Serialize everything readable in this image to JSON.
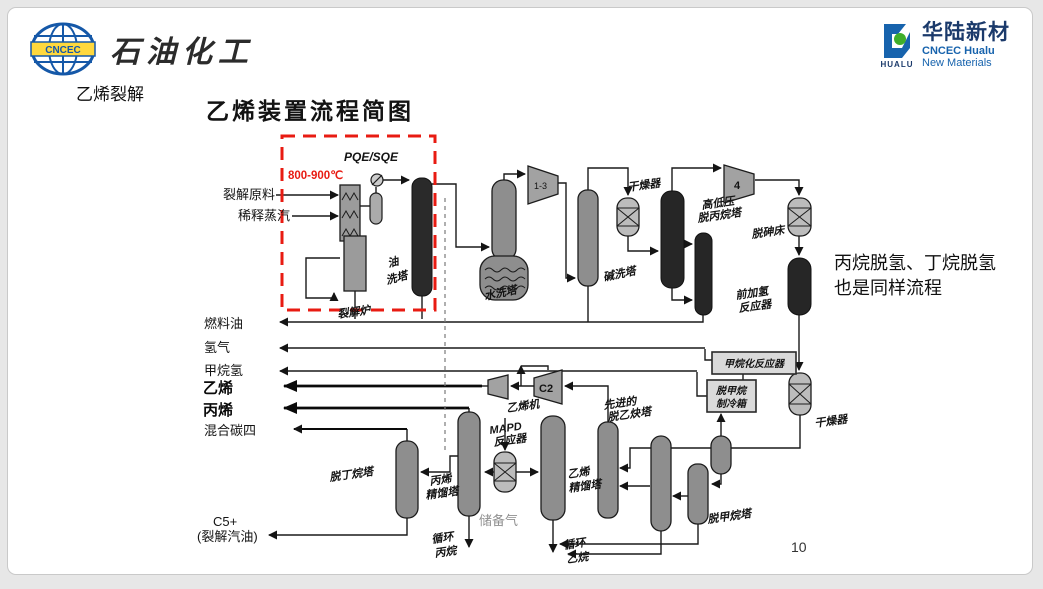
{
  "header": {
    "left_logo": {
      "banner": "CNCEC",
      "brand": "石油化工"
    },
    "right_logo": {
      "cn": "华陆新材",
      "en1": "CNCEC Hualu",
      "en2": "New Materials",
      "word": "HUALU"
    }
  },
  "slide": {
    "section": "乙烯裂解",
    "title": "乙烯装置流程简图",
    "note1": "丙烷脱氢、丁烷脱氢",
    "note2": "也是同样流程",
    "page": "10"
  },
  "diagram": {
    "feed1": "裂解原料",
    "feed2": "稀释蒸汽",
    "temp": "800-900℃",
    "pqe": "PQE/SQE",
    "furnace": "裂解炉",
    "oil1": "油",
    "oil2": "洗塔",
    "water": "水洗塔",
    "caustic": "碱洗塔",
    "dryer_top": "干燥器",
    "hplp1": "高低压",
    "hplp2": "脱丙烷塔",
    "dearsenic": "脱砷床",
    "fh1": "前加氢",
    "fh2": "反应器",
    "methanation": "甲烷化反应器",
    "cb1": "脱甲烷",
    "cb2": "制冷箱",
    "dryer_right": "干燥器",
    "demethanizer": "脱甲烷塔",
    "da1": "先进的",
    "da2": "脱乙炔塔",
    "ec1": "乙烯",
    "ec2": "精馏塔",
    "re1": "循环",
    "re2": "乙烷",
    "mapd1": "MAPD",
    "mapd2": "反应器",
    "reserve": "储备气",
    "pc1": "丙烯",
    "pc2": "精馏塔",
    "rp1": "循环",
    "rp2": "丙烷",
    "debutanizer": "脱丁烷塔",
    "k13": "1-3",
    "k4": "4",
    "kc2": "C2",
    "emachine": "乙烯机",
    "fuel": "燃料油",
    "h2": "氢气",
    "ch4h2": "甲烷氢",
    "ethylene": "乙烯",
    "propylene": "丙烯",
    "c4": "混合碳四",
    "c5": "C5+",
    "c5sub": "(裂解汽油)"
  },
  "colors": {
    "accent_red": "#e81b12",
    "logo_blue": "#1558a8",
    "logo_yellow": "#ffd83d",
    "logo_green": "#3fae2a",
    "navy": "#1b3a6b"
  }
}
